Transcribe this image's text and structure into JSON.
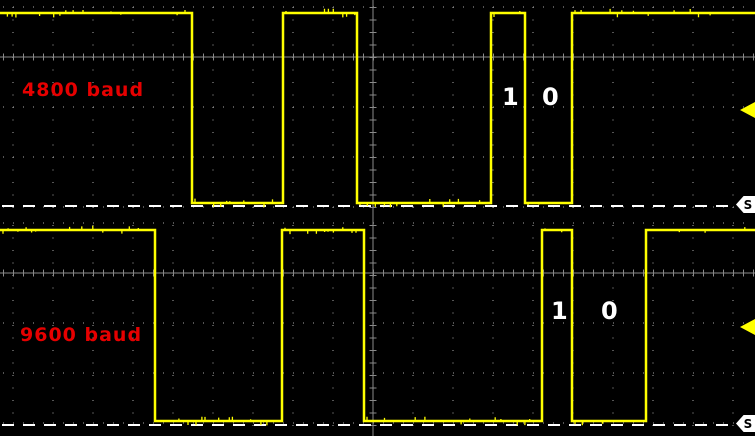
{
  "scope": {
    "width": 755,
    "height": 436,
    "colors": {
      "background": "#000000",
      "trace": "#ffff00",
      "grid_line": "#8a8a8a",
      "grid_dot": "#a8a8a8",
      "baseline_dash": "#ffffff",
      "baud_label": "#e60000",
      "bit_label": "#ffffff",
      "trigger_marker_bg": "#ffffff",
      "trigger_marker_text": "#000000",
      "channel_arrow": "#ffff00"
    },
    "graticule": {
      "col_start_x": 13,
      "col_spacing": 40,
      "col_count": 19,
      "col_dot_period": 12.5,
      "row_dot_period": 10,
      "center_col_x": 373,
      "tick_len": 7
    },
    "panels": [
      {
        "label": "4800 baud",
        "label_pos": {
          "x": 22,
          "y": 81
        },
        "start_level": "high",
        "edges_x": [
          192,
          283,
          357,
          491,
          525,
          572
        ],
        "high_y": 13,
        "low_y": 203,
        "axis_y": 57,
        "rows_y": [
          7,
          107,
          157,
          207
        ],
        "ground_y": 206,
        "bits": [
          {
            "text": "1",
            "x": 502,
            "y": 85
          },
          {
            "text": "0",
            "x": 542,
            "y": 85
          }
        ],
        "arrow_tip_y": 110,
        "trigger_label": "S",
        "trigger_tip_y": 204
      },
      {
        "label": "9600 baud",
        "label_pos": {
          "x": 20,
          "y": 108
        },
        "start_level": "high",
        "edges_x": [
          155,
          282,
          364,
          542,
          572,
          646
        ],
        "high_y": 12,
        "low_y": 203,
        "axis_y": 55,
        "rows_y": [
          5,
          105,
          155,
          205
        ],
        "ground_y": 207,
        "bits": [
          {
            "text": "1",
            "x": 551,
            "y": 81
          },
          {
            "text": "0",
            "x": 601,
            "y": 81
          }
        ],
        "arrow_tip_y": 109,
        "trigger_label": "S",
        "trigger_tip_y": 205
      }
    ]
  },
  "chart_data": [
    {
      "type": "line",
      "title": "4800 baud",
      "subtitle": "UART serial data square wave, logic high/low vs time",
      "start_level": "high",
      "levels": [
        "high",
        "low"
      ],
      "transitions_x_px": [
        192,
        283,
        357,
        491,
        525,
        572
      ],
      "x_range_px": [
        0,
        755
      ],
      "high_level_y_px": 13,
      "low_level_y_px": 203,
      "bit_annotations": [
        {
          "label": "1",
          "x_px": 509
        },
        {
          "label": "0",
          "x_px": 550
        }
      ],
      "grid": "dotted graticule with solid center axes and minor ticks",
      "baseline": "dashed white line at logic-low level ending in trigger marker S",
      "legend_position": "none"
    },
    {
      "type": "line",
      "title": "9600 baud",
      "subtitle": "UART serial data square wave, logic high/low vs time",
      "start_level": "high",
      "levels": [
        "high",
        "low"
      ],
      "transitions_x_px": [
        155,
        282,
        364,
        542,
        572,
        646
      ],
      "x_range_px": [
        0,
        755
      ],
      "high_level_y_px": 12,
      "low_level_y_px": 203,
      "bit_annotations": [
        {
          "label": "1",
          "x_px": 558
        },
        {
          "label": "0",
          "x_px": 609
        }
      ],
      "grid": "dotted graticule with solid center axes and minor ticks",
      "baseline": "dashed white line at logic-low level ending in trigger marker S",
      "legend_position": "none"
    }
  ]
}
